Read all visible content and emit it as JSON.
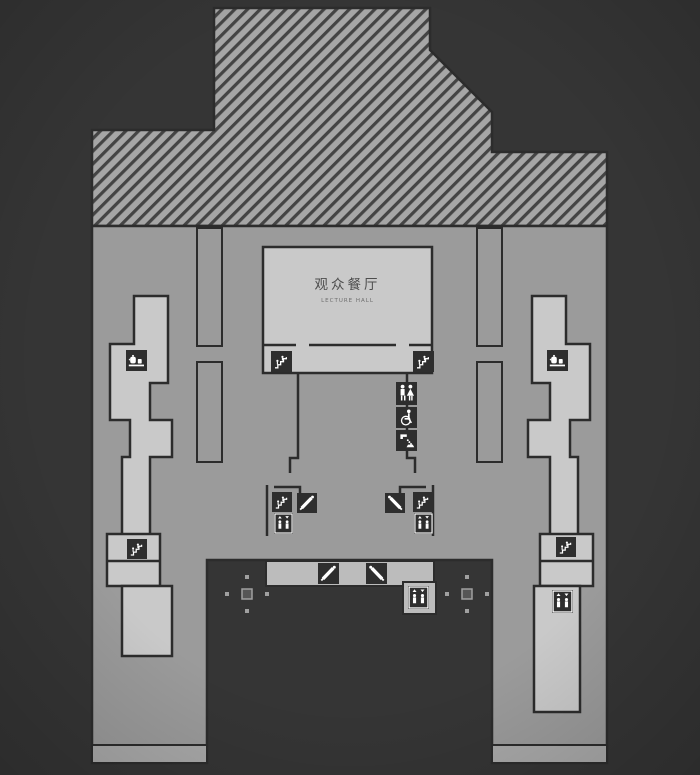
{
  "hall": {
    "label_zh": "观众餐厅",
    "label_en": "LECTURE HALL"
  },
  "facility_icons": [
    "escalator-icon",
    "escalator-down-icon",
    "escalator-up-icon",
    "elevator-icon",
    "restroom-icon",
    "accessible-icon",
    "drinking-fountain-icon",
    "water-dispenser-icon",
    "column-marker"
  ],
  "colors": {
    "bg": "#353535",
    "floor": "#9b9b9b",
    "hatch_fill": "#a6a6a6",
    "hatch_stripe": "#444444",
    "room": "#c9c9c9",
    "bar": "#bcbcbc",
    "wall": "#2c2c2c",
    "tile": "#2e2e2e",
    "glyph": "#ffffff",
    "dot": "#a0a0a0",
    "leg_foot": "#a9a9a9",
    "text": "#4d4d4d",
    "text_sub": "#6e6e6e"
  }
}
